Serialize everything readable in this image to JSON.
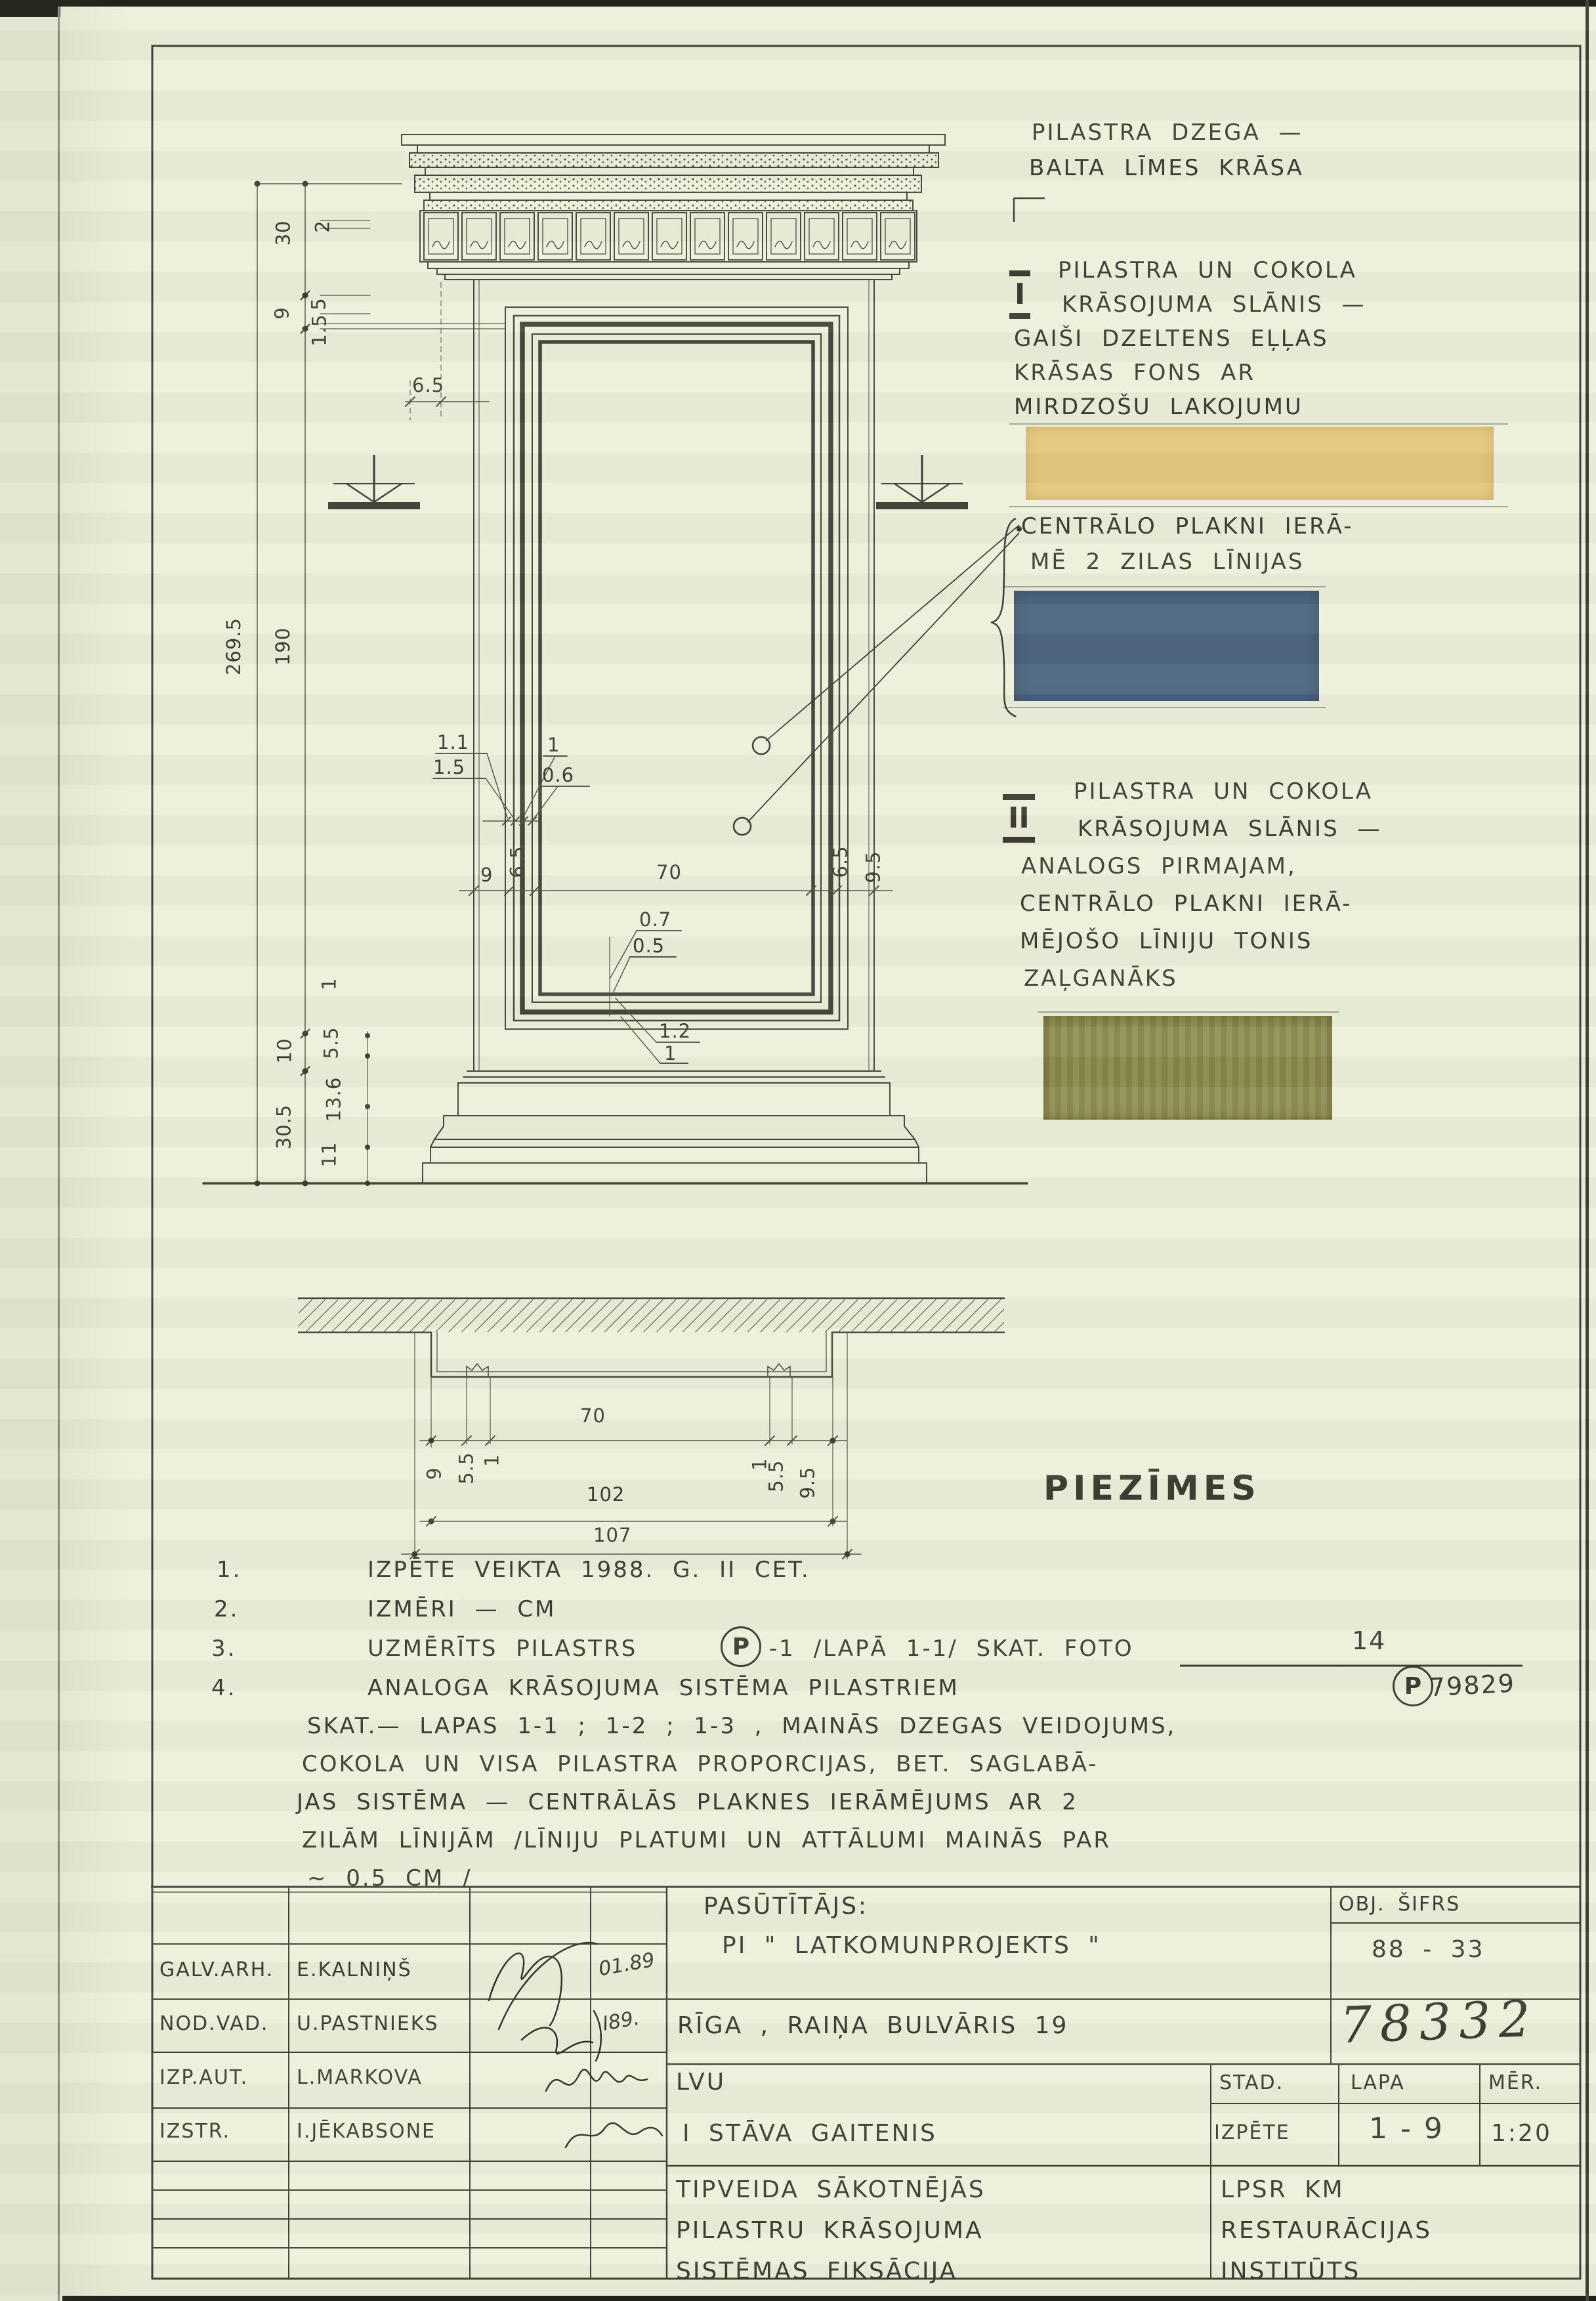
{
  "page": {
    "bg": "#ecefd9",
    "ink": "#3b3b32"
  },
  "legend": {
    "dzega": [
      "PILASTRA DZEGA —",
      "BALTA LĪMES KRĀSA"
    ],
    "layer1_numeral": "I",
    "layer1": [
      "PILASTRA UN COKOLA",
      "KRĀSOJUMA SLĀNIS —",
      "GAIŠI DZELTENS EĻĻAS",
      "KRĀSAS FONS AR",
      "MIRDZOŠU LAKOJUMU"
    ],
    "central": [
      "CENTRĀLO PLAKNI IERĀ-",
      "MĒ 2 ZILAS LĪNIJAS"
    ],
    "layer2_numeral": "II",
    "layer2": [
      "PILASTRA UN COKOLA",
      "KRĀSOJUMA SLĀNIS —",
      "ANALOGS PIRMAJAM,",
      "CENTRĀLO PLAKNI IERĀ-",
      "MĒJOŠO LĪNIJU TONIS",
      "ZAĻGANĀKS"
    ],
    "swatch_yellow": "#e3c77c",
    "swatch_blue": "#4b6580",
    "swatch_olive": "#8c8b4d"
  },
  "notes": {
    "title": "PIEZĪMES",
    "n1_num": "1.",
    "n1": "IZPĒTE VEIKTA 1988. G. II CET.",
    "n2_num": "2.",
    "n2": "IZMĒRI — CM",
    "n3_num": "3.",
    "n3_a": "UZMĒRĪTS PILASTRS",
    "n3_p": "P",
    "n3_b": "-1 /LAPĀ 1-1/ SKAT. FOTO",
    "n3_frac_top": "14",
    "n3_frac_bottom": "79829",
    "n4_num": "4.",
    "n4_p": "P",
    "n4": [
      "ANALOGA KRĀSOJUMA SISTĒMA PILASTRIEM",
      "SKAT.— LAPAS 1-1 ; 1-2 ; 1-3  , MAINĀS DZEGAS VEIDOJUMS,",
      "COKOLA UN VISA PILASTRA PROPORCIJAS, BET. SAGLABĀ-",
      "JAS SISTĒMA — CENTRĀLĀS PLAKNES IERĀMĒJUMS AR 2",
      "ZILĀM LĪNIJĀM /LĪNIJU PLATUMI UN ATTĀLUMI MAINĀS PAR",
      "~ 0.5 CM /"
    ]
  },
  "dims": {
    "d30": "30",
    "d2": "2",
    "d9": "9",
    "d5": "5",
    "d15": "1.5",
    "d65top": "6.5",
    "total": "269.5",
    "shaft": "190",
    "l11": "1.1",
    "l15": "1.5",
    "l1": "1",
    "l06": "0.6",
    "w9": "9",
    "w65l": "6.5",
    "w70": "70",
    "w65r": "6.5",
    "w95": "9.5",
    "b07": "0.7",
    "b05": "0.5",
    "b12": "1.2",
    "b1": "1",
    "base1": "1",
    "base55": "5.5",
    "base136": "13.6",
    "base11": "11",
    "base10": "10",
    "base305": "30.5",
    "p70": "70",
    "p102": "102",
    "p107": "107",
    "p9": "9",
    "p55l": "5.5",
    "p1l": "1",
    "p1r": "1",
    "p55r": "5.5",
    "p95": "9.5"
  },
  "titleblock": {
    "rows": [
      {
        "role": "GALV.ARH.",
        "name": "E.KALNIŅŠ",
        "date": "01.89"
      },
      {
        "role": "NOD.VAD.",
        "name": "U.PASTNIEKS",
        "date": "I89."
      },
      {
        "role": "IZP.AUT.",
        "name": "L.MARKOVA",
        "date": ""
      },
      {
        "role": "IZSTR.",
        "name": "I.JĒKABSONE",
        "date": ""
      }
    ],
    "client_label": "PASŪTĪTĀJS:",
    "client_name": "PI \" LATKOMUNPROJEKTS \"",
    "obj_code_label": "OBJ. ŠIFRS",
    "obj_code": "88 - 33",
    "address": "RĪGA , RAIŅA BULVĀRIS 19",
    "stamp_number": "78332",
    "object": "LVU",
    "object_sub": "I STĀVA GAITENIS",
    "stage_label": "STAD.",
    "stage": "IZPĒTE",
    "sheet_label": "LAPA",
    "sheet": "1 - 9",
    "scale_label": "MĒR.",
    "scale": "1:20",
    "doc_title": [
      "TIPVEIDA  SĀKOTNĒJĀS",
      "PILASTRU  KRĀSOJUMA",
      "SISTĒMAS  FIKSĀCIJA"
    ],
    "org": [
      "LPSR  KM",
      "RESTAURĀCIJAS",
      "INSTITŪTS"
    ]
  }
}
